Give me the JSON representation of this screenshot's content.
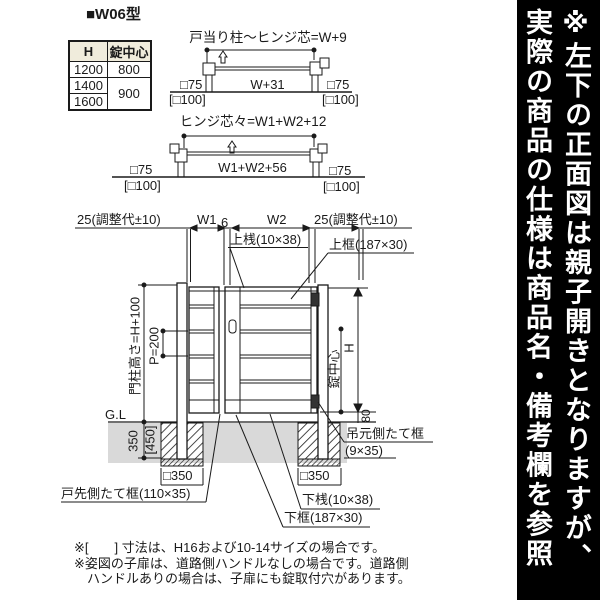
{
  "title": "■W06型",
  "spec_table": {
    "headers": [
      "H",
      "錠中心"
    ],
    "rows": [
      [
        "1200",
        "800"
      ],
      [
        "1400",
        "900"
      ],
      [
        "1600",
        ""
      ]
    ]
  },
  "diagram1": {
    "title": "戸当り柱〜ヒンジ芯=W+9",
    "left_post": "□75",
    "left_post_alt": "[□100]",
    "width_dim": "W+31",
    "right_post": "□75",
    "right_post_alt": "[□100]"
  },
  "diagram2": {
    "title": "ヒンジ芯々=W1+W2+12",
    "left_post": "□75",
    "left_post_alt": "[□100]",
    "width_dim": "W1+W2+56",
    "right_post": "□75",
    "right_post_alt": "[□100]"
  },
  "elevation": {
    "adj_left": "25(調整代±10)",
    "w1": "W1",
    "gap": "6",
    "w2": "W2",
    "adj_right": "25(調整代±10)",
    "top_rail": "上桟(10×38)",
    "top_frame": "上框(187×30)",
    "pillar_height": "門柱高さ=H+100",
    "pitch": "P=200",
    "ground_line": "G.L",
    "embed_depth": "350",
    "embed_depth_alt": "[450]",
    "lock_center": "錠中心",
    "height": "H",
    "bottom_clearance": "80",
    "footing_left": "□350",
    "footing_right": "□350",
    "hinge_stile": "吊元側たて框",
    "hinge_stile_size": "(9×35)",
    "latch_stile": "戸先側たて框(110×35)",
    "bottom_rail": "下桟(10×38)",
    "bottom_frame": "下框(187×30)"
  },
  "notes": [
    "※[　　] 寸法は、H16および10-14サイズの場合です。",
    "※姿図の子扉は、道路側ハンドルなしの場合です。道路側",
    "　ハンドルありの場合は、子扉にも錠取付穴があります。"
  ],
  "side_banner": {
    "line1": "※左下の正面図は親子開きとなりますが、",
    "line2": "実際の商品の仕様は商品名・備考欄を参照"
  },
  "colors": {
    "ink": "#1a1a1a",
    "ground_gray": "#d9d9d9",
    "table_header_bg": "#f0ecdc",
    "banner_bg": "#000000",
    "banner_fg": "#ffffff"
  }
}
